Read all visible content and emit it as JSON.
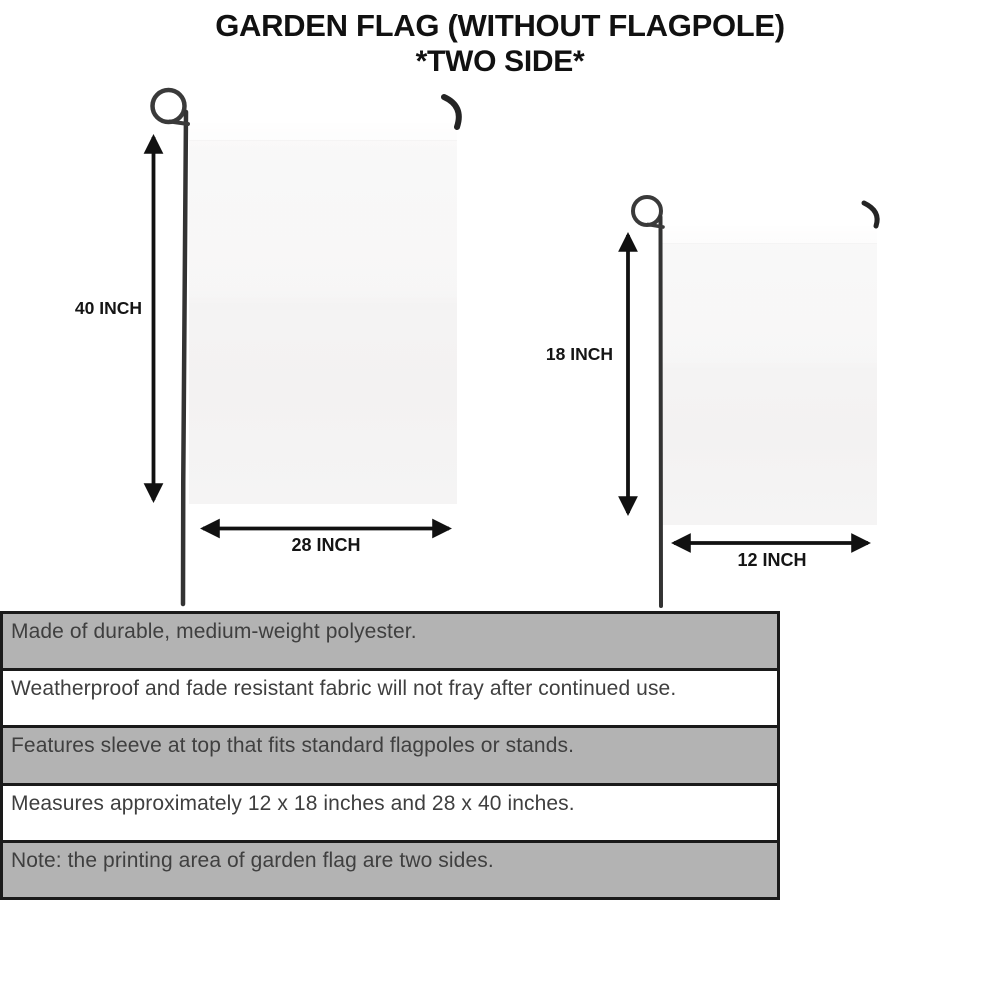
{
  "title": {
    "line1": "GARDEN FLAG (WITHOUT FLAGPOLE)",
    "line2": "*TWO SIDE*"
  },
  "diagrams": {
    "large_flag": {
      "height_label": "40 INCH",
      "width_label": "28 INCH"
    },
    "small_flag": {
      "height_label": "18 INCH",
      "width_label": "12 INCH"
    }
  },
  "features": {
    "rows": [
      {
        "text": "Made of durable, medium-weight polyester.",
        "shade": "gray"
      },
      {
        "text": "Weatherproof and fade resistant fabric will not fray after continued use.",
        "shade": "white"
      },
      {
        "text": "Features sleeve at top that fits standard flagpoles or stands.",
        "shade": "gray"
      },
      {
        "text": "Measures approximately 12 x 18 inches and 28 x 40 inches.",
        "shade": "white"
      },
      {
        "text": "Note: the printing area of garden flag are two sides.",
        "shade": "gray"
      }
    ]
  },
  "colors": {
    "background": "#ffffff",
    "row_gray": "#b3b3b3",
    "row_white": "#ffffff",
    "table_border": "#1a1a1a",
    "flag_fill": "#f5f4f4",
    "pole_stroke": "#3a3a3a",
    "arrow_stroke": "#111111",
    "title_text": "#111111",
    "feature_text": "#3f3f3f"
  }
}
